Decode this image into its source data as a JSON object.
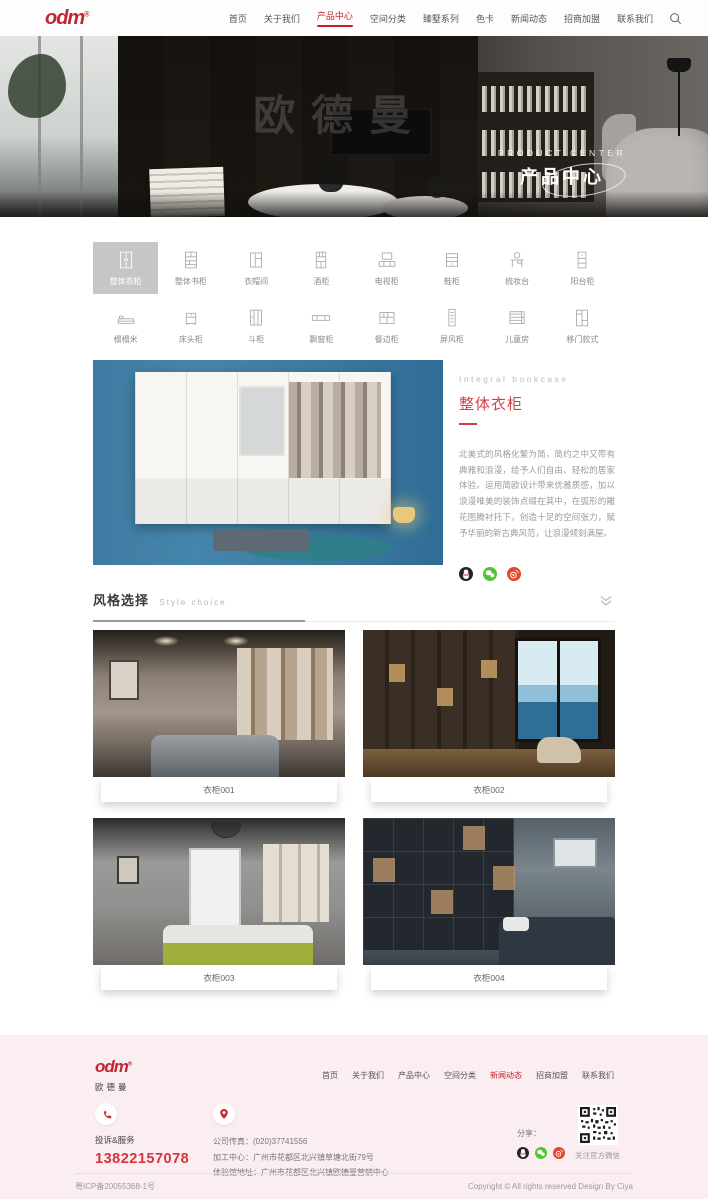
{
  "colors": {
    "accent_red": "#c7202c",
    "title_red": "#d3404b",
    "footer_bg": "#fbeef0",
    "active_category_bg": "#c6c6c5",
    "phone_red": "#d9323f"
  },
  "icons": {
    "search": "magnifier",
    "chevron": "double-chevron-down",
    "phone": "handset",
    "location": "map-pin",
    "qq": "qq-penguin",
    "wechat": "wechat-bubbles",
    "weibo": "weibo-sun",
    "qr": "wechat-qr-code"
  },
  "header": {
    "logo": "odm",
    "logo_reg": "®",
    "nav": [
      {
        "label": "首页"
      },
      {
        "label": "关于我们"
      },
      {
        "label": "产品中心",
        "active": true
      },
      {
        "label": "空间分类"
      },
      {
        "label": "臻墅系列"
      },
      {
        "label": "色卡"
      },
      {
        "label": "新闻动态"
      },
      {
        "label": "招商加盟"
      },
      {
        "label": "联系我们"
      }
    ]
  },
  "hero": {
    "watermark": "欧德曼",
    "en_title": "PRODUCT CENTER",
    "cn_title": "产品中心"
  },
  "categories": {
    "row1": [
      {
        "label": "整体衣柜",
        "active": true
      },
      {
        "label": "整体书柜"
      },
      {
        "label": "衣帽间"
      },
      {
        "label": "酒柜"
      },
      {
        "label": "电视柜"
      },
      {
        "label": "鞋柜"
      },
      {
        "label": "梳妆台"
      },
      {
        "label": "阳台柜"
      }
    ],
    "row2": [
      {
        "label": "榻榻米"
      },
      {
        "label": "床头柜"
      },
      {
        "label": "斗柜"
      },
      {
        "label": "飘窗柜"
      },
      {
        "label": "餐边柜"
      },
      {
        "label": "屏风柜"
      },
      {
        "label": "儿童房"
      },
      {
        "label": "移门款式"
      }
    ]
  },
  "product": {
    "en_title": "Integral bookcase",
    "title": "整体衣柜",
    "description": "北美式的风格化繁为简，简约之中又带有典雅和浪漫，给予人们自由、轻松的居家体验。运用简欧设计带来优雅质感，加以浪漫唯美的装饰点缀在其中，在弧形的雕花图腾衬托下，创造十足的空间张力，赋予华丽的新古典风范，让浪漫倾刻满屋。"
  },
  "style_section": {
    "title": "风格选择",
    "subtitle": "Style choice"
  },
  "cards": [
    {
      "label": "衣柜001"
    },
    {
      "label": "衣柜002"
    },
    {
      "label": "衣柜003"
    },
    {
      "label": "衣柜004"
    }
  ],
  "footer": {
    "logo": "odm",
    "logo_reg": "®",
    "logo_sub": "欧德曼",
    "nav": [
      {
        "label": "首页"
      },
      {
        "label": "关于我们"
      },
      {
        "label": "产品中心"
      },
      {
        "label": "空间分类"
      },
      {
        "label": "新闻动态",
        "active": true
      },
      {
        "label": "招商加盟"
      },
      {
        "label": "联系我们"
      }
    ],
    "service_label": "投诉&服务",
    "phone": "13822157078",
    "fax": "公司传真：(020)37741556",
    "address1": "加工中心：广州市花都区北兴镇草塘北街79号",
    "address2": "体验馆地址：广州市花都区北兴镇欧德曼营销中心",
    "share_label": "分享：",
    "qr_caption": "关注官方微信"
  },
  "bottom": {
    "icp": "粤ICP备20055368-1号",
    "copyright": "Copyright © All rights reserved Design By Ciya"
  }
}
